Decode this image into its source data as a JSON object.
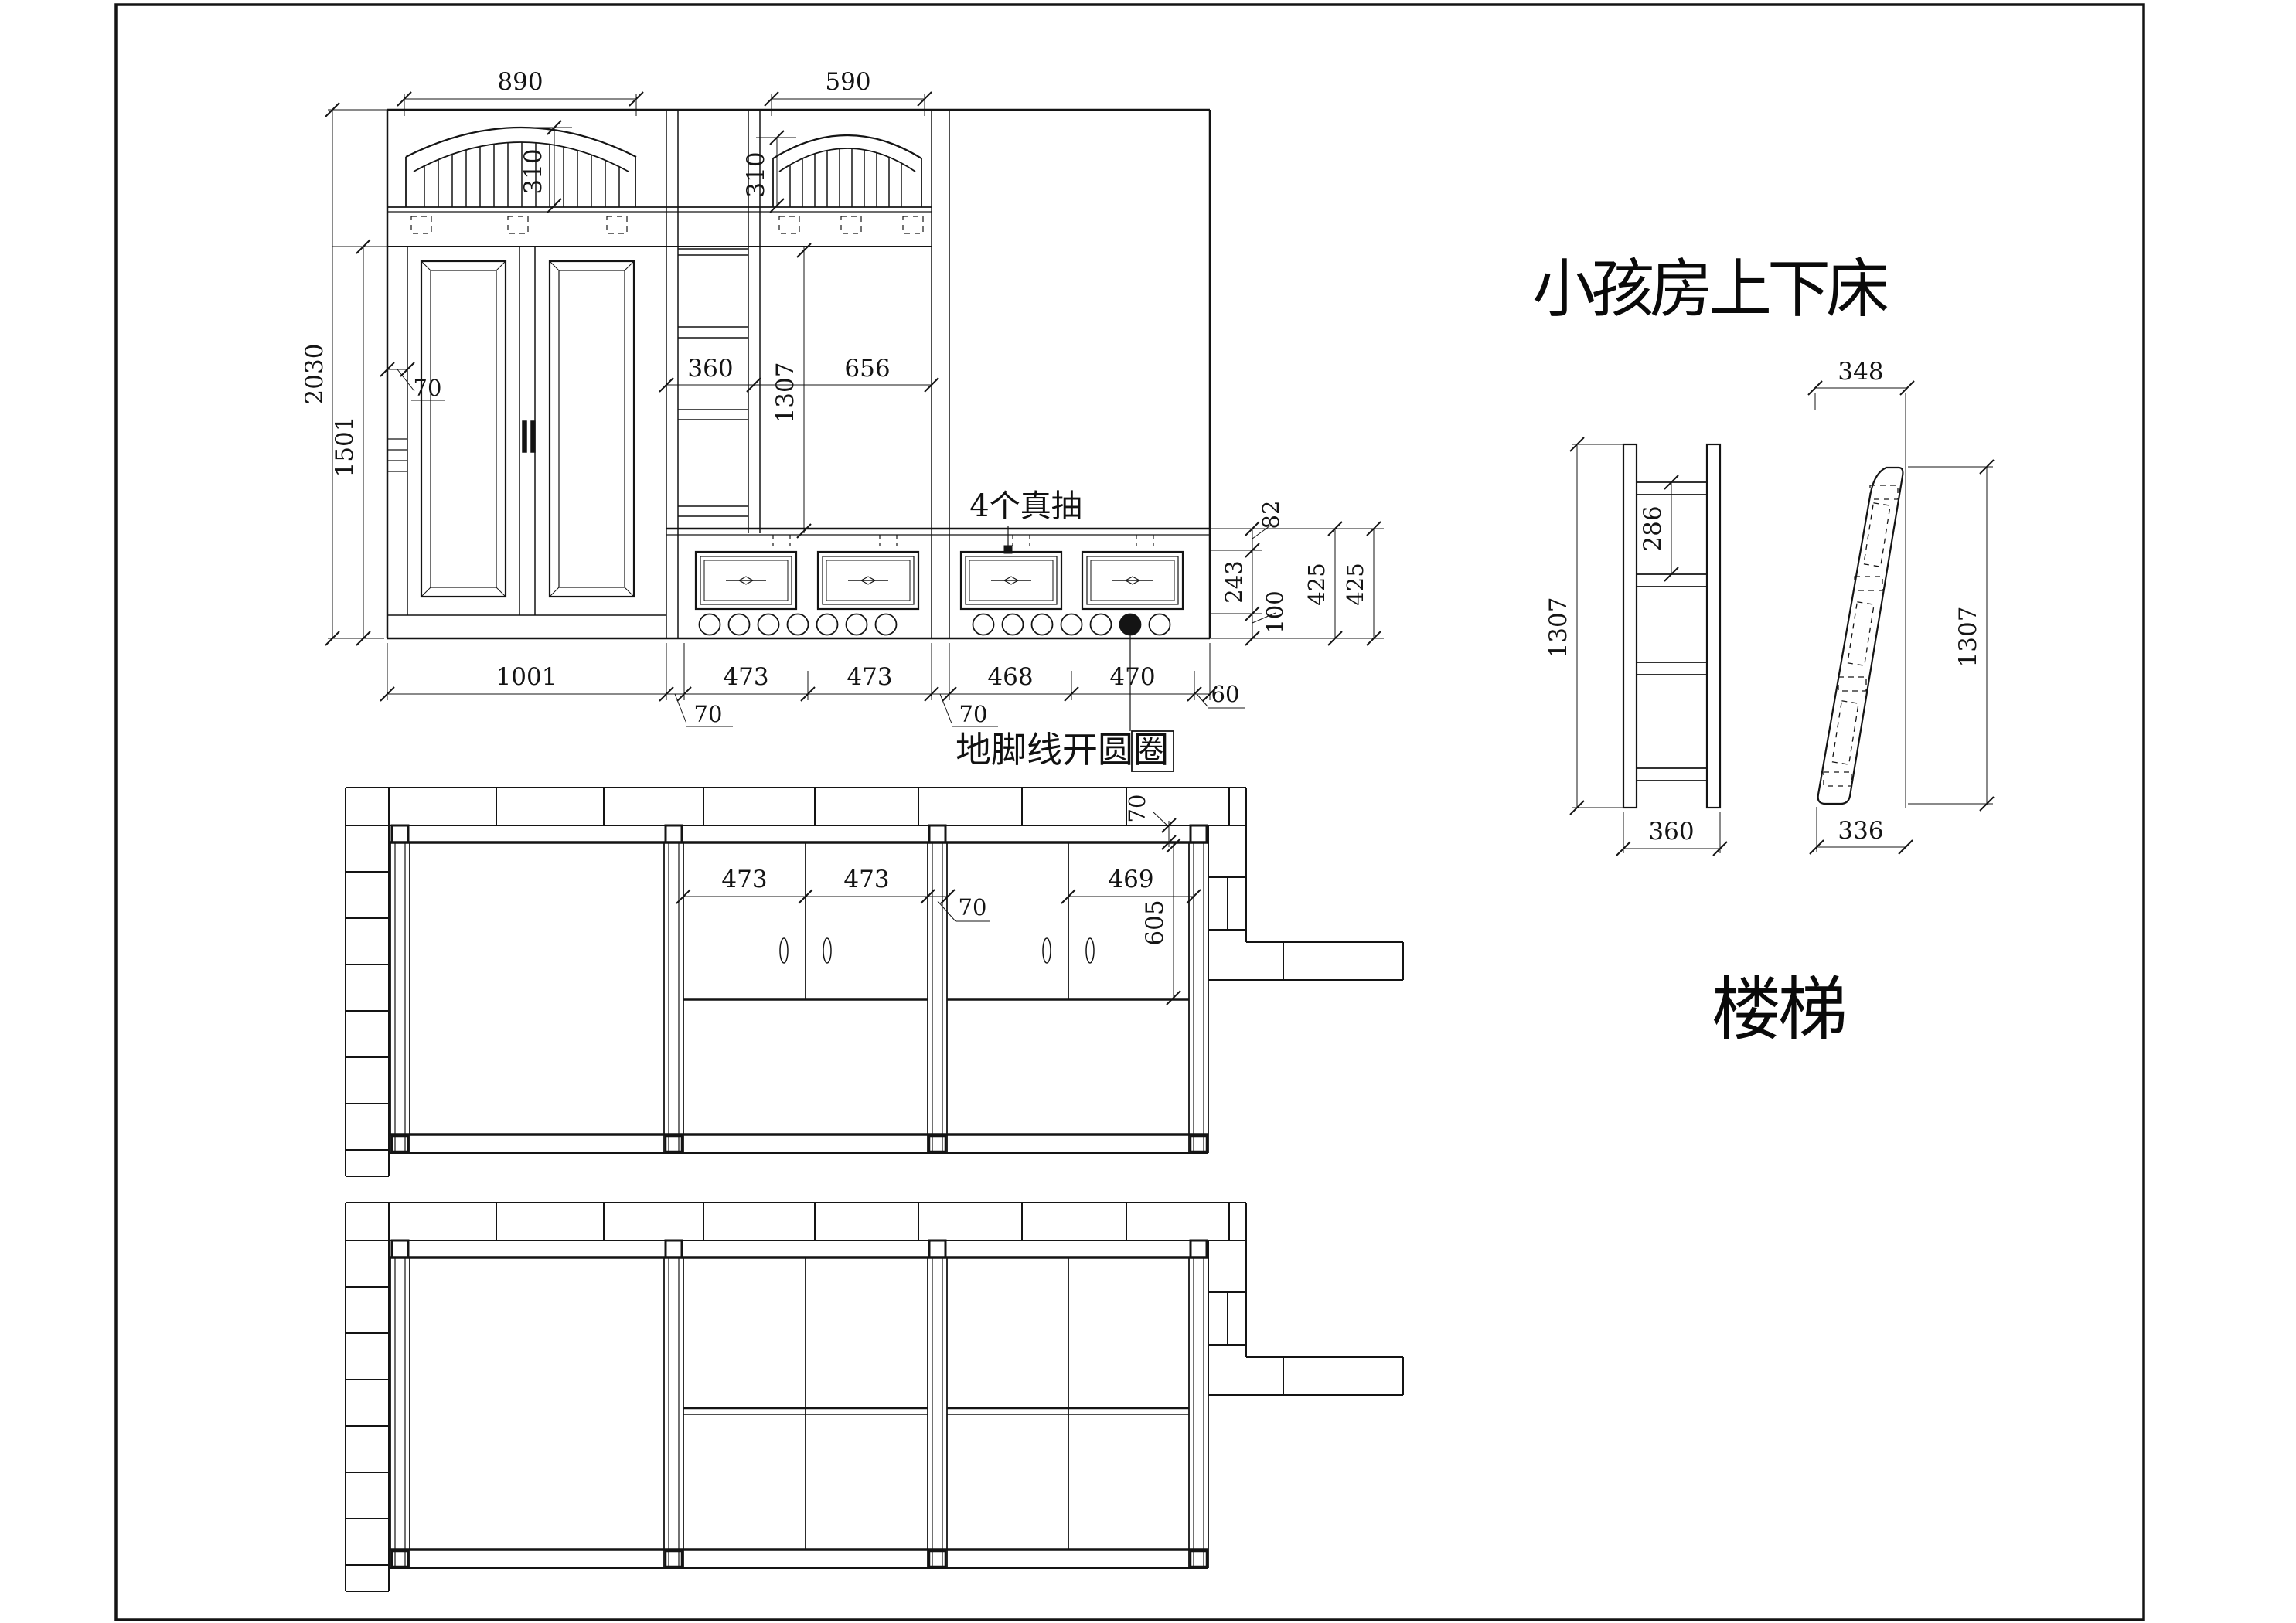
{
  "titles": {
    "main": "小孩房上下床",
    "ladder": "楼梯"
  },
  "notes": {
    "drawers": "4个真抽",
    "skirting": "地脚线开圆圈"
  },
  "elevation": {
    "top_dims": {
      "left_bay": "890",
      "mid_bay": "590"
    },
    "arch_dims": {
      "left": "310",
      "mid": "310"
    },
    "left_dims": {
      "total_height": "2030",
      "door_height": "1501",
      "stile": "70"
    },
    "mid_dims": {
      "column_width": "360",
      "cabinet_height": "1307",
      "cabinet_width": "656"
    },
    "right_dims": {
      "crown": "82",
      "drawer": "243",
      "base": "100",
      "zone_a": "425",
      "zone_b": "425"
    },
    "bottom_dims": {
      "wardrobe": "1001",
      "gap1": "70",
      "bay1": "473",
      "bay2": "473",
      "gap2": "70",
      "bay3": "468",
      "bay4": "470",
      "end": "60"
    }
  },
  "plan_mid": {
    "dims": {
      "door1": "473",
      "door2": "473",
      "post": "70",
      "door3": "469",
      "depth": "605",
      "wall_gap": "70"
    }
  },
  "ladder_front": {
    "dims": {
      "height": "1307",
      "step": "286",
      "width": "360"
    }
  },
  "ladder_side": {
    "dims": {
      "top": "348",
      "height": "1307",
      "bottom": "336"
    }
  }
}
